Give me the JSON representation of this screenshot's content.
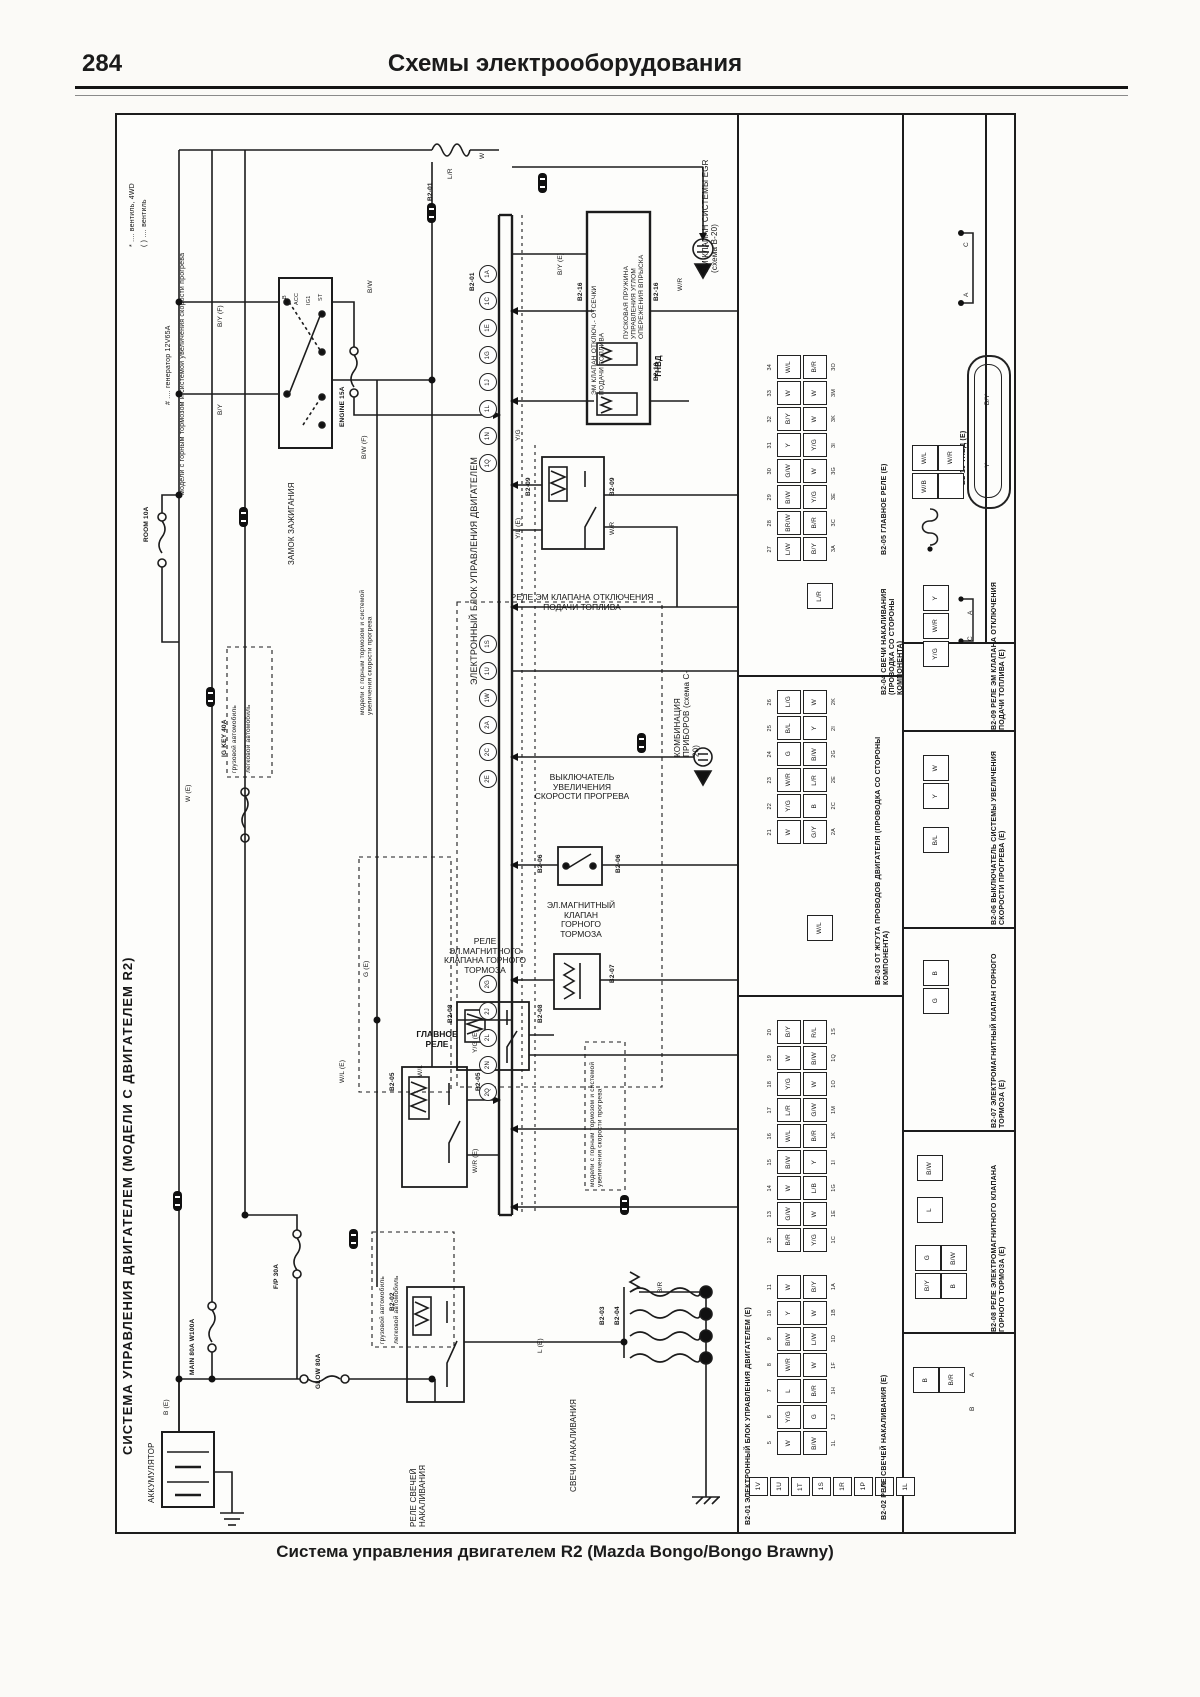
{
  "header": {
    "page_number": "284",
    "title": "Схемы электрооборудования"
  },
  "caption": "Система управления двигателем R2 (Mazda Bongo/Bongo Brawny)",
  "spine_title": "СИСТЕМА УПРАВЛЕНИЯ ДВИГАТЕЛЕМ (МОДЕЛИ С ДВИГАТЕЛЕМ R2)",
  "footnotes": {
    "f1": "* .... вентиль, 4WD",
    "f2": "( ) .... вентиль",
    "f3": "# .... генератор 12V65A",
    "f4": "модели с горным тормозом и системой увеличения скорости прогрева"
  },
  "labels": {
    "ecu": "ЭЛЕКТРОННЫЙ БЛОК УПРАВЛЕНИЯ ДВИГАТЕЛЕМ",
    "ignition": "ЗАМОК ЗАЖИГАНИЯ",
    "battery": "АККУМУЛЯТОР",
    "glow_relay": "РЕЛЕ СВЕЧЕЙ НАКАЛИВАНИЯ",
    "glow_plugs": "СВЕЧИ НАКАЛИВАНИЯ",
    "main_relay": "ГЛАВНОЕ РЕЛЕ",
    "mb_relay": "РЕЛЕ ЭЛ.МАГНИТНОГО КЛАПАНА ГОРНОГО ТОРМОЗА",
    "mb_valve": "ЭЛ.МАГНИТНЫЙ КЛАПАН ГОРНОГО ТОРМОЗА",
    "warm_switch": "ВЫКЛЮЧАТЕЛЬ УВЕЛИЧЕНИЯ СКОРОСТИ ПРОГРЕВА",
    "fuelcut_relay": "РЕЛЕ ЭМ КЛАПАНА ОТКЛЮЧЕНИЯ ПОДАЧИ ТОПЛИВА",
    "tnvd": "ТНВД",
    "inj_valve": "ПУСКОВАЯ ПРУЖИНА УПРАВЛЕНИЯ УГЛОМ ОПЕРЕЖЕНИЯ ВПРЫСКА",
    "cut_valve": "ЭМ КЛАПАН ОТКЛЮЧ.- ОТСЕЧКИ ПОДАЧИ ТОПЛИВА",
    "egr": "ЭМ КЛАПАН СИСТЕМЫ EGR (схема B-20)",
    "combo": "КОМБИНАЦИЯ ПРИБОРОВ (схема C-20)",
    "note": "модели с горным тормозом и системой увеличения скорости прогрева",
    "truck": "грузовой автомобиль",
    "car": "легковой автомобиль"
  },
  "ign": {
    "b": "B",
    "acc": "ACC",
    "ig": "IG1",
    "st": "ST"
  },
  "fuses": {
    "engine": "ENGINE 15A",
    "room": "ROOM 10A",
    "igkey": "IG KEY 40A",
    "fp": "F/P 30A",
    "main": "MAIN 80A W100A",
    "glow": "GLOW 80A"
  },
  "ids": {
    "c01": "B2-01",
    "c02": "B2-02",
    "c03": "B2-03",
    "c04": "B2-04",
    "c05": "B2-05",
    "c06": "B2-06",
    "c07": "B2-07",
    "c08": "B2-08",
    "c09": "B2-09",
    "c10": "B2-10",
    "c16": "B2-16"
  },
  "wires": {
    "w1": "B/Y (F)",
    "w2": "B/Y",
    "w3": "B/W (F)",
    "w4": "L/R",
    "w5": "W (E)",
    "w6": "B (E)",
    "w7": "W/L (E)",
    "w8": "W/L",
    "w9": "Y/G (E)",
    "w10": "W/R (E)",
    "w11": "G (E)",
    "w12": "Y/L (E)",
    "w13": "Y/G",
    "w14": "W/R",
    "w15": "L (E)",
    "w16": "B/R",
    "w17": "W",
    "w18": "B/Y (E)",
    "w19": "W/R",
    "w20": "B/W"
  },
  "pins": {
    "g1": [
      "1A",
      "1C",
      "1E",
      "1G",
      "1J",
      "1L",
      "1N",
      "1Q"
    ],
    "g2": [
      "1S",
      "1U",
      "1W",
      "2A",
      "2C",
      "2E"
    ],
    "g3": [
      "2G",
      "2J",
      "2L",
      "2N",
      "2Q"
    ]
  },
  "panel": {
    "sections": {
      "s01": "B2-01 ЭЛЕКТРОННЫЙ БЛОК УПРАВЛЕНИЯ ДВИГАТЕЛЕМ (E)",
      "s02": "B2-02 РЕЛЕ СВЕЧЕЙ НАКАЛИВАНИЯ (E)",
      "s03": "B2-03 ОТ ЖГУТА ПРОВОДОВ ДВИГАТЕЛЯ (ПРОВОДКА СО СТОРОНЫ КОМПОНЕНТА)",
      "s04": "B2-04 СВЕЧИ НАКАЛИВАНИЯ (ПРОВОДКА СО СТОРОНЫ КОМПОНЕНТА)",
      "s05": "B2-05 ГЛАВНОЕ РЕЛЕ (E)",
      "s06": "B2-06 ВЫКЛЮЧАТЕЛЬ СИСТЕМЫ УВЕЛИЧЕНИЯ СКОРОСТИ ПРОГРЕВА (E)",
      "s07": "B2-07 ЭЛЕКТРОМАГНИТНЫЙ КЛАПАН ГОРНОГО ТОРМОЗА (E)",
      "s08": "B2-08 РЕЛЕ ЭЛЕКТРОМАГНИТНОГО КЛАПАНА ГОРНОГО ТОРМОЗА (E)",
      "s09": "B2-09 РЕЛЕ ЭМ КЛАПАНА ОТКЛЮЧЕНИЯ ПОДАЧИ ТОПЛИВА (E)",
      "s10": "B2-10 ТНВД (E)"
    },
    "tables": {
      "t1": [
        {
          "n1": "34",
          "c1": "W/L",
          "c2": "B/R",
          "n2": "3O"
        },
        {
          "n1": "33",
          "c1": "W",
          "c2": "W",
          "n2": "3M"
        },
        {
          "n1": "32",
          "c1": "B/Y",
          "c2": "W",
          "n2": "3K"
        },
        {
          "n1": "31",
          "c1": "Y",
          "c2": "Y/G",
          "n2": "3I"
        },
        {
          "n1": "30",
          "c1": "G/W",
          "c2": "W",
          "n2": "3G"
        },
        {
          "n1": "29",
          "c1": "B/W",
          "c2": "Y/G",
          "n2": "3E"
        },
        {
          "n1": "28",
          "c1": "BR/W",
          "c2": "B/R",
          "n2": "3C"
        },
        {
          "n1": "27",
          "c1": "L/W",
          "c2": "B/Y",
          "n2": "3A"
        }
      ],
      "t2": [
        {
          "n1": "26",
          "c1": "L/G",
          "c2": "W",
          "n2": "2K"
        },
        {
          "n1": "25",
          "c1": "B/L",
          "c2": "Y",
          "n2": "2I"
        },
        {
          "n1": "24",
          "c1": "G",
          "c2": "B/W",
          "n2": "2G"
        },
        {
          "n1": "23",
          "c1": "W/R",
          "c2": "L/R",
          "n2": "2E"
        },
        {
          "n1": "22",
          "c1": "Y/G",
          "c2": "B",
          "n2": "2C"
        },
        {
          "n1": "21",
          "c1": "W",
          "c2": "G/Y",
          "n2": "2A"
        }
      ],
      "t3": [
        {
          "n1": "20",
          "c1": "B/Y",
          "c2": "R/L",
          "n2": "1S"
        },
        {
          "n1": "19",
          "c1": "W",
          "c2": "B/W",
          "n2": "1Q"
        },
        {
          "n1": "18",
          "c1": "Y/G",
          "c2": "W",
          "n2": "1O"
        },
        {
          "n1": "17",
          "c1": "L/R",
          "c2": "G/W",
          "n2": "1M"
        },
        {
          "n1": "16",
          "c1": "W/L",
          "c2": "B/R",
          "n2": "1K"
        },
        {
          "n1": "15",
          "c1": "B/W",
          "c2": "Y",
          "n2": "1I"
        },
        {
          "n1": "14",
          "c1": "W",
          "c2": "L/B",
          "n2": "1G"
        },
        {
          "n1": "13",
          "c1": "G/W",
          "c2": "W",
          "n2": "1E"
        },
        {
          "n1": "12",
          "c1": "B/R",
          "c2": "Y/G",
          "n2": "1C"
        }
      ],
      "t4": [
        {
          "n1": "11",
          "c1": "W",
          "c2": "B/Y",
          "n2": "1A"
        },
        {
          "n1": "10",
          "c1": "Y",
          "c2": "W",
          "n2": "1B"
        },
        {
          "n1": "9",
          "c1": "B/W",
          "c2": "L/W",
          "n2": "1D"
        },
        {
          "n1": "8",
          "c1": "W/R",
          "c2": "W",
          "n2": "1F"
        },
        {
          "n1": "7",
          "c1": "L",
          "c2": "B/R",
          "n2": "1H"
        },
        {
          "n1": "6",
          "c1": "Y/G",
          "c2": "G",
          "n2": "1J"
        },
        {
          "n1": "5",
          "c1": "W",
          "c2": "B/W",
          "n2": "1L"
        }
      ]
    },
    "bottom_row": [
      "1V",
      "1U",
      "1T",
      "1S",
      "1R",
      "1P",
      "1N",
      "1L"
    ],
    "conn_cells": {
      "b205": [
        "W/L",
        "W/R",
        "W/B",
        ""
      ],
      "b210": [
        "B/Y",
        "Y"
      ],
      "b209": [
        "Y",
        "W/R",
        "Y/G"
      ],
      "b206": [
        "W",
        "Y"
      ],
      "b206b": [
        "B/L"
      ],
      "b207": [
        "B",
        "G"
      ],
      "b208a": [
        "B/W"
      ],
      "b208b": [
        "L"
      ],
      "b208c": [
        "G",
        "B/W",
        "B/Y",
        "B"
      ],
      "b202": [
        "B",
        "B/R"
      ],
      "b204": [
        "L/R"
      ],
      "b203": [
        "W/L"
      ]
    },
    "terminals": {
      "a": "A",
      "b": "B",
      "c": "C",
      "d": "D"
    }
  }
}
